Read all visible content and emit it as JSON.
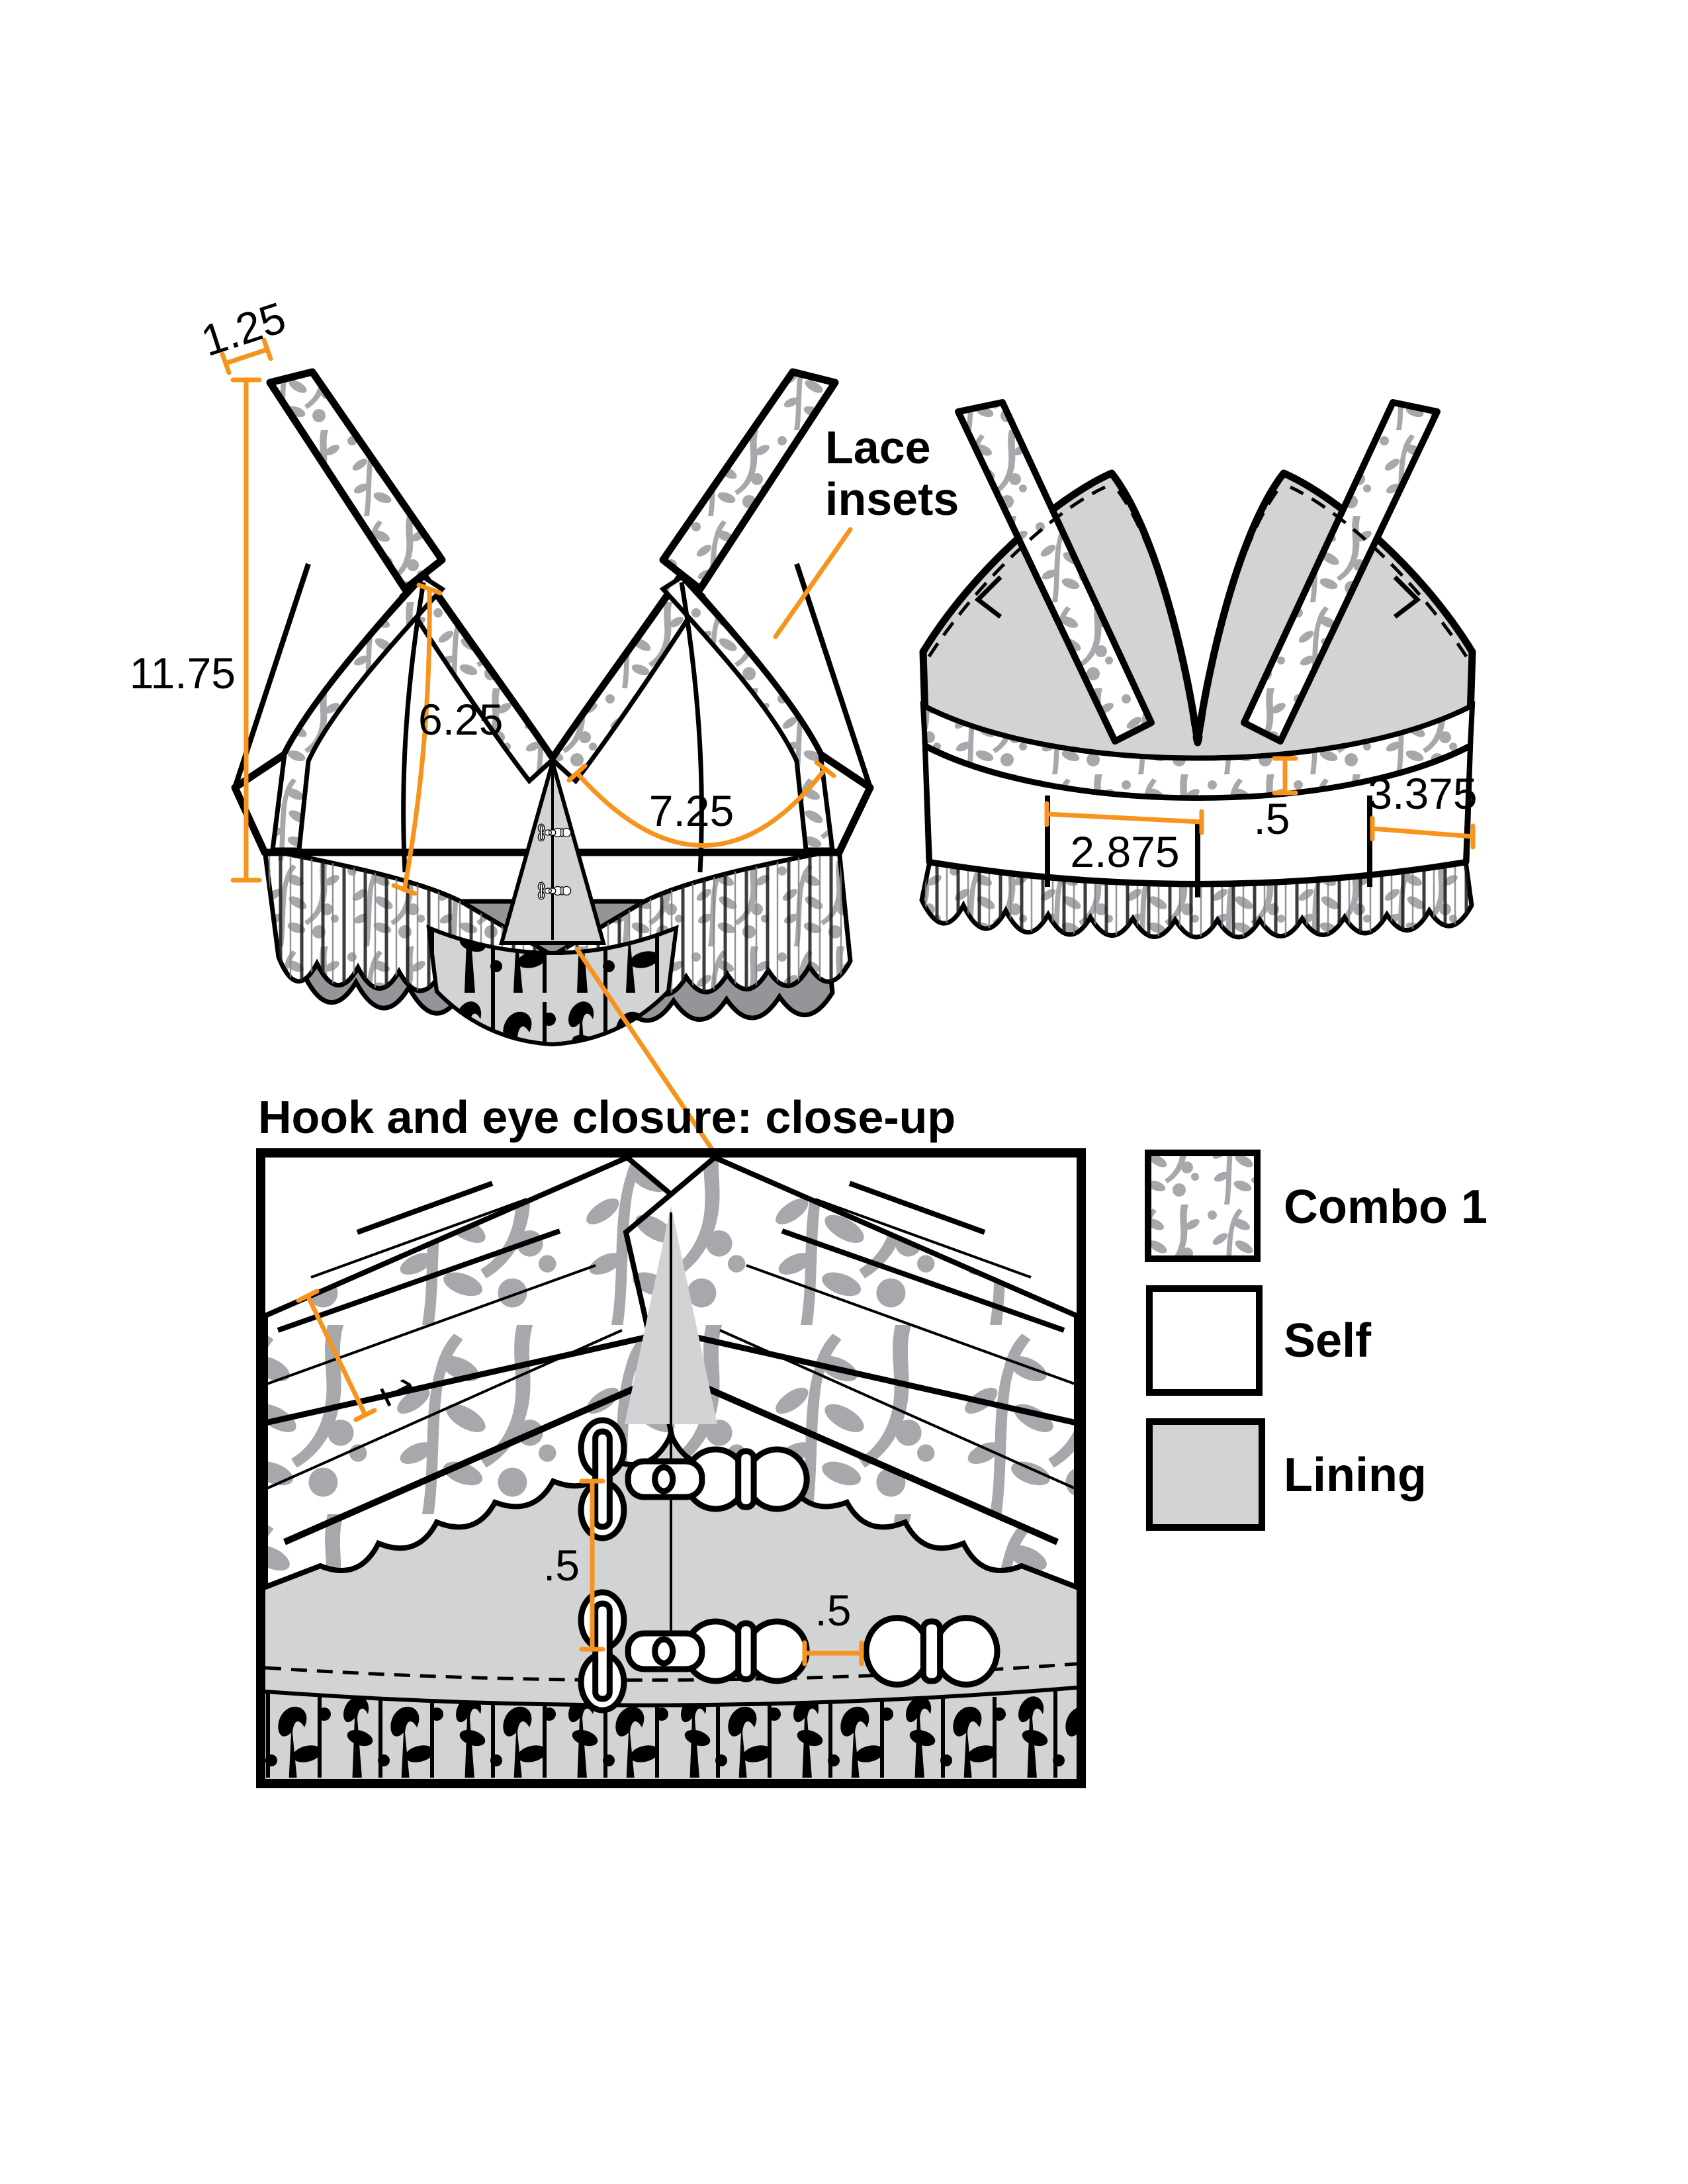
{
  "colors": {
    "accent": "#F7941E",
    "lining_gray": "#D1D3D4",
    "pattern_gray": "#A6A8AB",
    "ruffle_gray": "#939598",
    "outline": "#000000"
  },
  "front_view": {
    "measurements": {
      "strap_width": "1.25",
      "side_height": "11.75",
      "cup_seam_length": "6.25",
      "cup_bottom_width": "7.25"
    }
  },
  "back_view": {
    "measurements": {
      "band_trim_width": ".5",
      "back_panel_width": "2.875",
      "side_back_panel_width": "3.375"
    }
  },
  "closeup": {
    "title": "Hook and eye closure: close-up",
    "measurements": {
      "ruffle_depth": "1",
      "hook_vertical_spacing": ".5",
      "hook_to_eye_spacing": ".5"
    }
  },
  "annotations": {
    "lace_insets_line1": "Lace",
    "lace_insets_line2": "insets"
  },
  "legend": {
    "items": [
      {
        "swatch": "combo1-floral",
        "label": "Combo 1"
      },
      {
        "swatch": "self-white",
        "label": "Self"
      },
      {
        "swatch": "lining-gray",
        "label": "Lining"
      }
    ]
  }
}
